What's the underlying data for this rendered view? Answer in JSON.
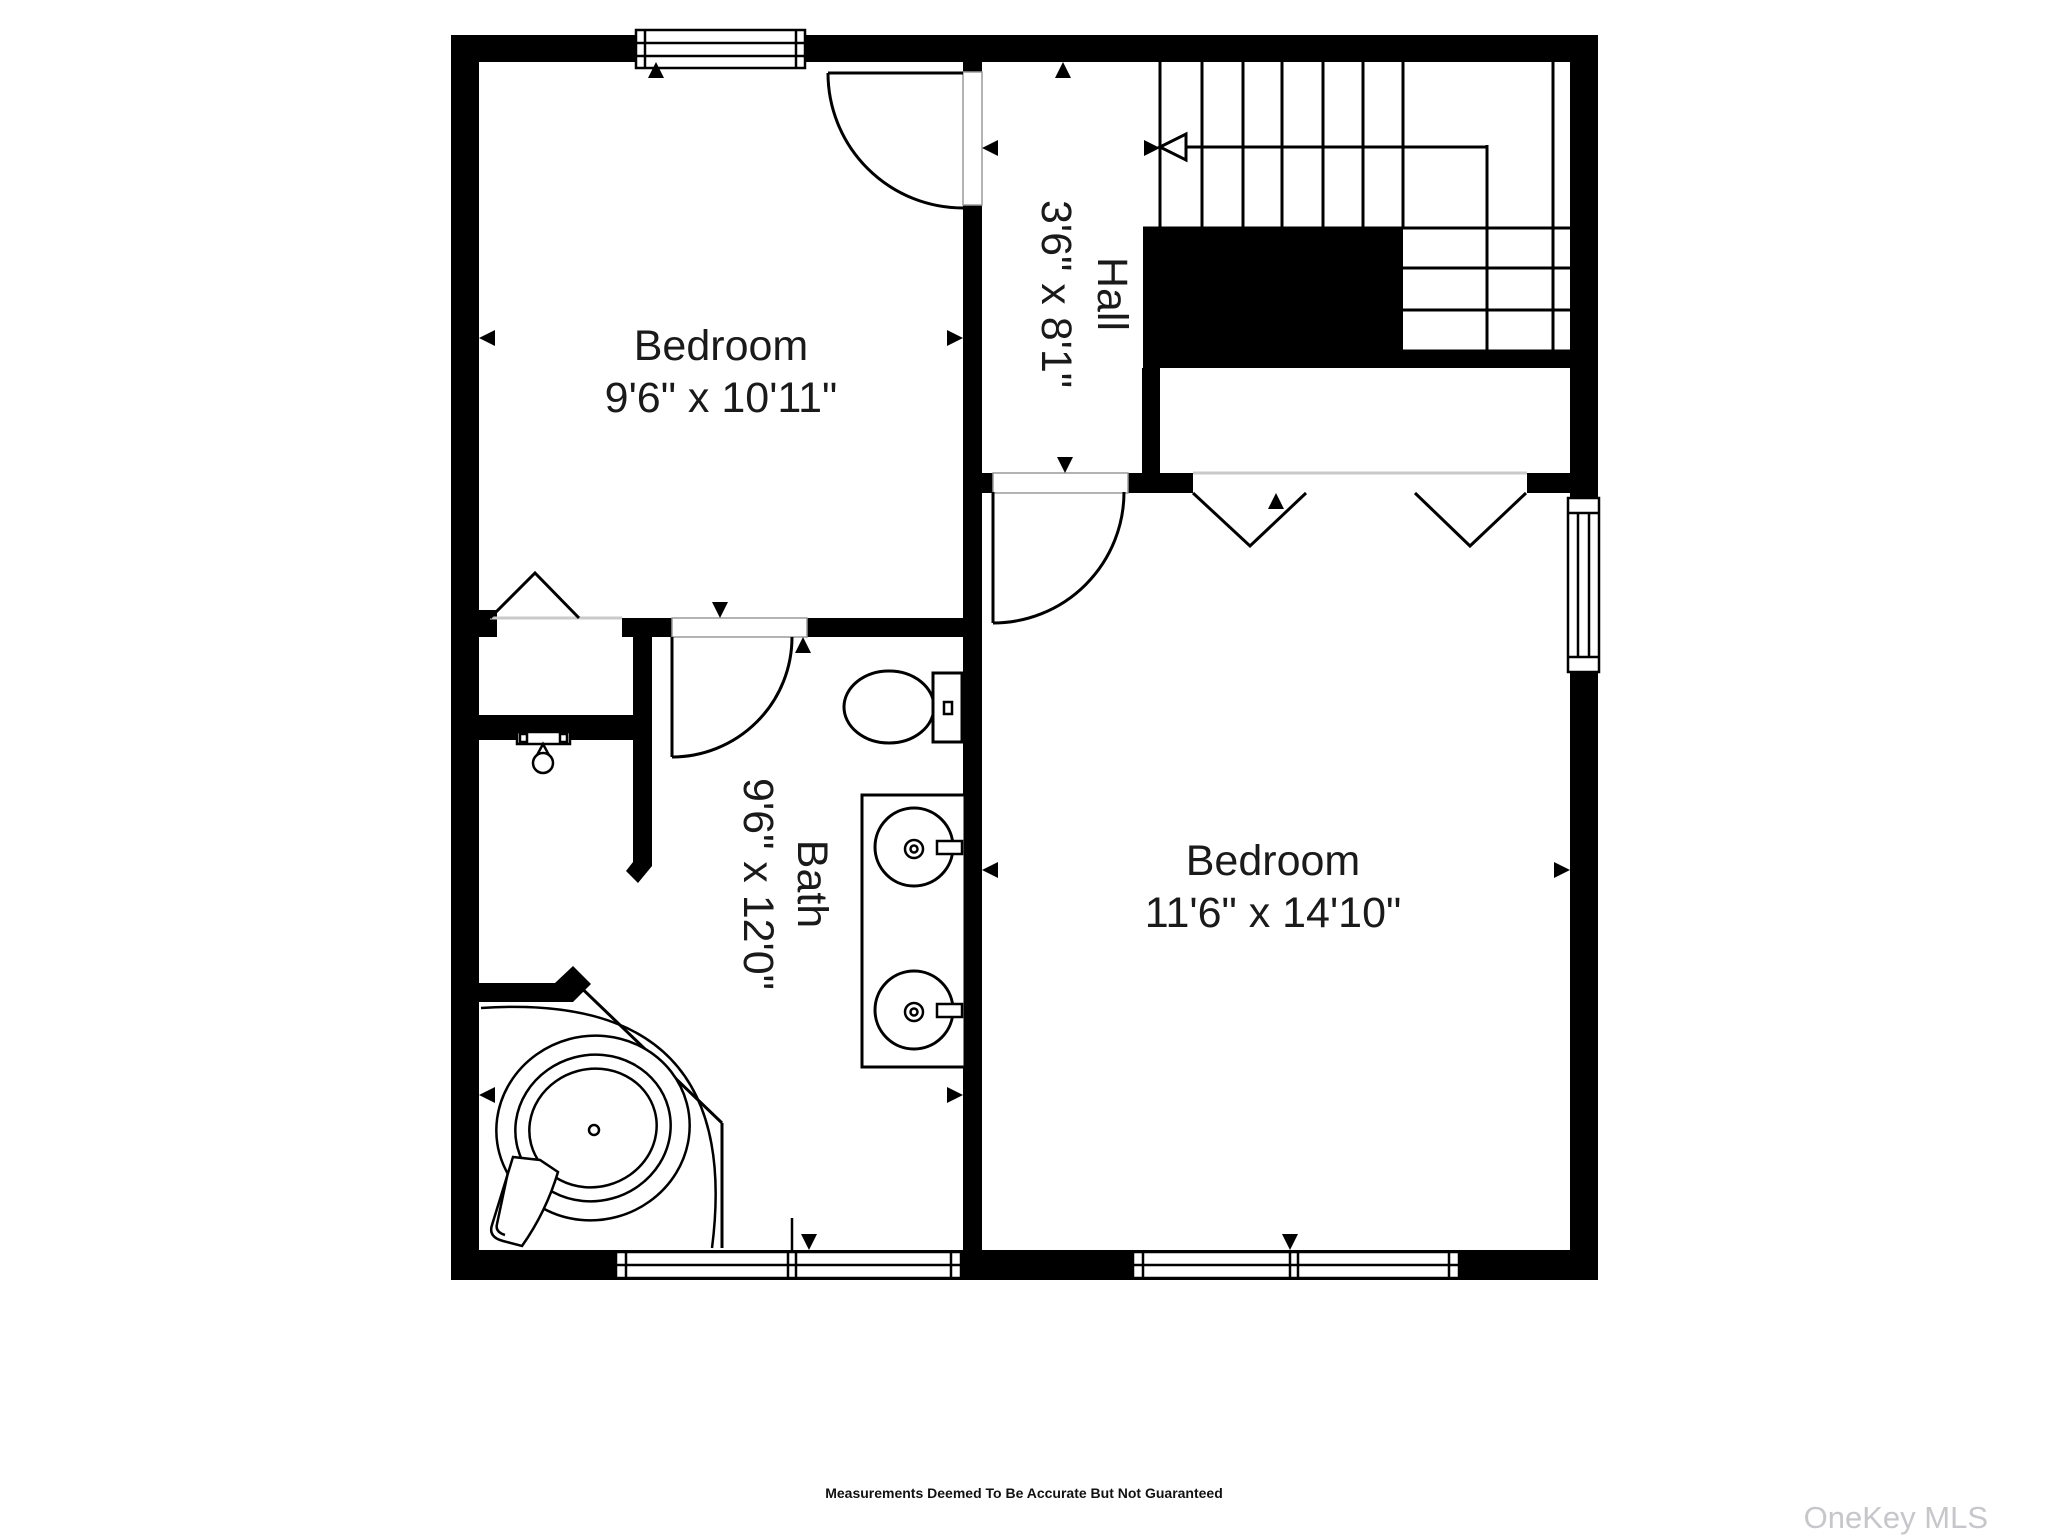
{
  "floorplan": {
    "wall_color": "#000000",
    "line_color": "#000000",
    "background_color": "#ffffff",
    "rooms": [
      {
        "id": "bedroom-top-left",
        "name": "Bedroom",
        "dimensions": "9'6\" x 10'11\"",
        "label_orientation": "horizontal"
      },
      {
        "id": "hall",
        "name": "Hall",
        "dimensions": "3'6\" x 8'1\"",
        "label_orientation": "rotated-90"
      },
      {
        "id": "bath",
        "name": "Bath",
        "dimensions": "9'6\" x 12'0\"",
        "label_orientation": "rotated-90"
      },
      {
        "id": "bedroom-right",
        "name": "Bedroom",
        "dimensions": "11'6\" x 14'10\"",
        "label_orientation": "horizontal"
      }
    ],
    "fixtures": [
      "staircase-up-arrow",
      "corner-bathtub",
      "double-sink-vanity",
      "toilet",
      "shower-head",
      "bifold-closet-doors",
      "windows",
      "doors"
    ],
    "footer": {
      "disclaimer": "Measurements Deemed To Be Accurate But Not Guaranteed"
    },
    "watermark": {
      "text": "OneKey MLS",
      "color": "#c6c6cb"
    }
  }
}
